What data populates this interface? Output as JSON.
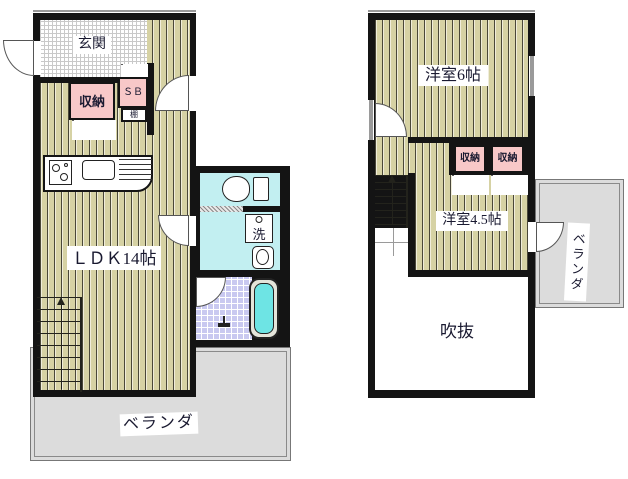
{
  "plan_title": "2-story floor plan",
  "colors": {
    "wall": "#141414",
    "tatami_floor": "#d6d2a4",
    "wet_room": "#c2eff1",
    "bath_tile": "#c9c9f0",
    "bathtub_water": "#6ee4e4",
    "closet_pink": "#f8c8c8",
    "veranda_gray": "#dcdcdc"
  },
  "floor1": {
    "entrance_label": "玄関",
    "storage_label": "収納",
    "shoebox_label": "ＳＢ",
    "shelf_label": "棚",
    "ldk_label": "ＬＤＫ14帖",
    "laundry_label": "洗",
    "veranda_label": "ベランダ"
  },
  "floor2": {
    "room6_label": "洋室6帖",
    "storage_left_label": "収納",
    "storage_right_label": "収納",
    "room45_label": "洋室4.5帖",
    "void_label": "吹抜",
    "veranda_label": "ベランダ"
  }
}
